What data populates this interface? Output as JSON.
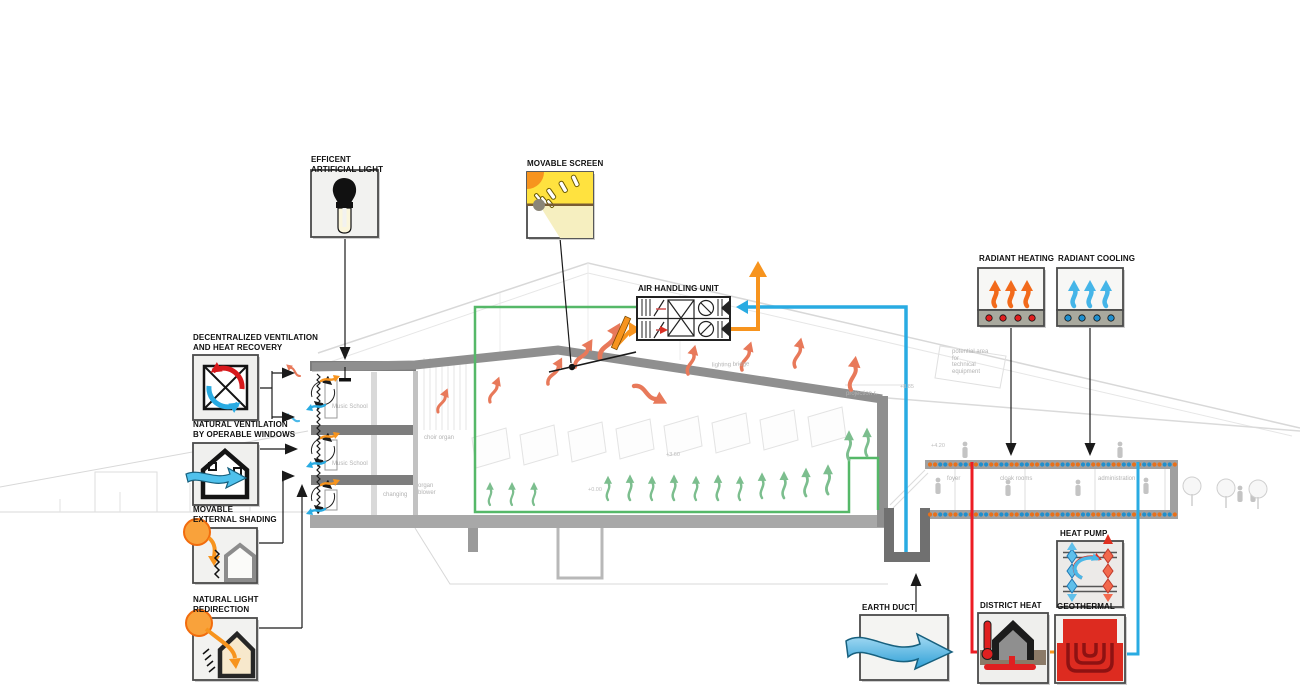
{
  "strategies": {
    "efficient_artificial_light": {
      "label": "EFFICENT\nARTIFICIAL LIGHT"
    },
    "movable_screen": {
      "label": "MOVABLE SCREEN"
    },
    "air_handling_unit": {
      "label": "AIR HANDLING UNIT"
    },
    "radiant_heating": {
      "label": "RADIANT HEATING"
    },
    "radiant_cooling": {
      "label": "RADIANT COOLING"
    },
    "decentralized_ventilation": {
      "label": "DECENTRALIZED VENTILATION\nAND HEAT RECOVERY"
    },
    "natural_ventilation": {
      "label": "NATURAL VENTILATION\nBY OPERABLE WINDOWS"
    },
    "movable_external_shading": {
      "label": "MOVABLE\nEXTERNAL SHADING"
    },
    "natural_light_redirection": {
      "label": "NATURAL LIGHT\nREDIRECTION"
    },
    "earth_duct": {
      "label": "EARTH DUCT"
    },
    "district_heat": {
      "label": "DISTRICT HEAT"
    },
    "geothermal": {
      "label": "GEOTHERMAL"
    },
    "heat_pump": {
      "label": "HEAT PUMP"
    }
  },
  "background_text": {
    "music_school_1": "Music School",
    "music_school_2": "Music School",
    "changing": "changing",
    "organ_blower": "organ\nblower",
    "choir_organ": "choir organ",
    "lighting_bridge": "lighting bridge",
    "projection_room": "projection r.",
    "potential_area": "potential area\nfor\ntechnical\nequipment",
    "foyer": "foyer",
    "cloak_rooms": "cloak rooms",
    "administration": "administration",
    "levels": {
      "l1": "+8.85",
      "l2": "+4.20",
      "l3": "+3.60",
      "l4": "+0.00"
    }
  },
  "colors": {
    "exhaust_orange": "#F7941E",
    "fresh_air_blue": "#29ABE2",
    "supply_green": "#55B868",
    "heating_red": "#ED1C24",
    "warm_air_coral": "#E8795A",
    "floor_supply_green": "#7CBE8E",
    "dot_orange": "#E8701A",
    "dot_blue": "#1F8FCE",
    "structure_gray": "#8F8F8F"
  }
}
